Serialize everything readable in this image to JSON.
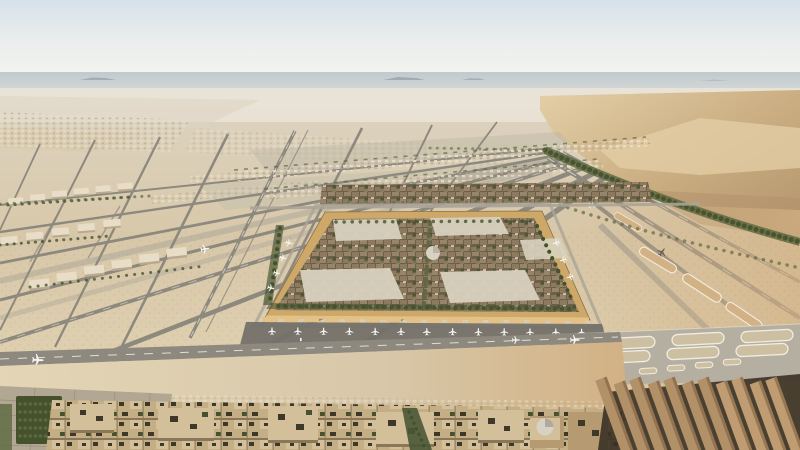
{
  "scene": {
    "alt": "Aerial concept rendering of a vast airport city in a sandy desert: a dense square district of mud-brown and cream low-rise buildings with green courtyards and a small dome sits on a gold-framed platform ringed by aircraft gates; a web of gray runways and taxiways with white oval taxi loops spreads across pale sand toward hazy dunes and a green vegetation belt on the horizon; dense flat-roofed courtyard blocks and long slab buildings fill the warm-lit foreground.",
    "colors": {
      "sky_top": "#d6e2ea",
      "sky_mid": "#eaeeed",
      "sky_low": "#f8f5ef",
      "horizon_haze": "#bac5cb",
      "horizon_haze_light": "#d3d7d4",
      "mesa": "#96a1ab",
      "far_desert": "#ddd4c3",
      "mid_sand": "#d8c8a9",
      "bright_sand": "#e3d5b5",
      "warm_sand": "#d2b184",
      "dune_light": "#e4cfa7",
      "dune_gold": "#c9ac80",
      "dune_shadow": "#b2926b",
      "vegetation_dark": "#45512c",
      "vegetation": "#5e6a41",
      "runway_gray": "#8e897e",
      "taxiway_light": "#aaa497",
      "paving_light": "#bdb6a6",
      "marking_white": "#f1ece0",
      "apron_dark": "#74716a",
      "band_concrete": "#b5afa2",
      "oval_fill": "#cdbfa2",
      "frame_gold": "#cda868",
      "frame_gold_light": "#e4c187",
      "city_base": "#6b5d47",
      "city_brown": "#8b7a5e",
      "city_brown_dark": "#6f5f48",
      "city_brown_light": "#97856b",
      "city_cream": "#d8d1bf",
      "city_green": "#4a5836",
      "dome_light": "#d8d1c4",
      "fg_block": "#c3ae86",
      "fg_block_light": "#d3c09a",
      "fg_block_mid": "#b59a72",
      "fg_shadow": "#8a7757",
      "fg_hole": "#3e3829",
      "fg_green": "#46522f",
      "slab_lit": "#b29068",
      "slab_bright": "#c09c72",
      "slab_shadow": "#3a3226",
      "slab_edge": "#7d5f3f",
      "plaza_gray": "#b1a792",
      "plaza_line": "#988e7a",
      "plane_white": "#f5f5f1",
      "plane_dark": "#6b6257",
      "sprawl_light": "#e8dec8",
      "sprawl_shadow": "#b8a98f"
    },
    "counts": {
      "gate_aircraft": 13,
      "stand_aircraft": 7,
      "taxiing_aircraft": 6,
      "taxiway_loops": 18,
      "foreground_slabs": 11
    }
  }
}
